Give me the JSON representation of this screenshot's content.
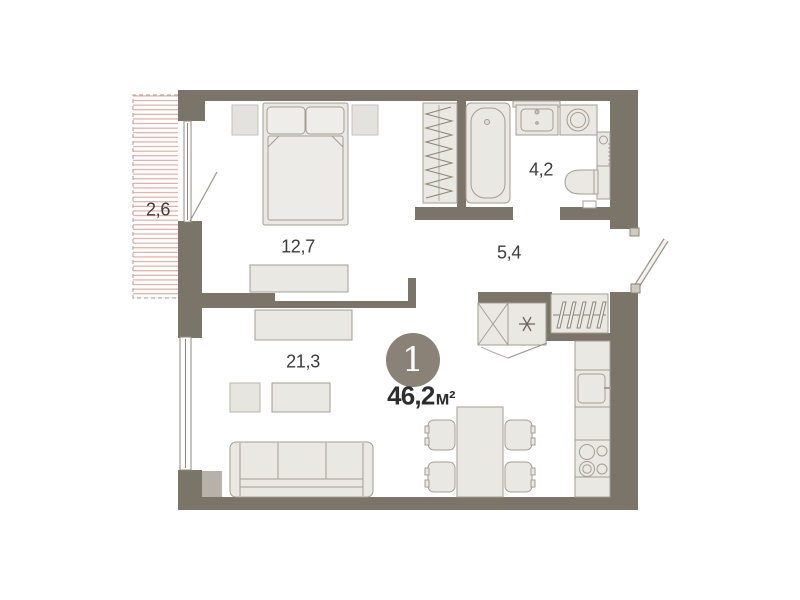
{
  "floor_plan": {
    "unit_badge": {
      "number": "1",
      "area_value": "46,2",
      "area_unit": "м²"
    },
    "rooms": {
      "balcony": {
        "label": "2,6"
      },
      "bedroom": {
        "label": "12,7"
      },
      "bathroom": {
        "label": "4,2"
      },
      "hallway": {
        "label": "5,4"
      },
      "living_kitchen": {
        "label": "21,3"
      }
    },
    "icons": {
      "fridge_icon_glyph": "✳"
    },
    "colors": {
      "wall": "#7b7468",
      "furniture_fill": "#eae8e3",
      "furniture_stroke": "#a39d94",
      "balcony_hatch": "#dba59e",
      "badge_background": "#8a8177",
      "label_text": "#3c3c3c"
    }
  }
}
